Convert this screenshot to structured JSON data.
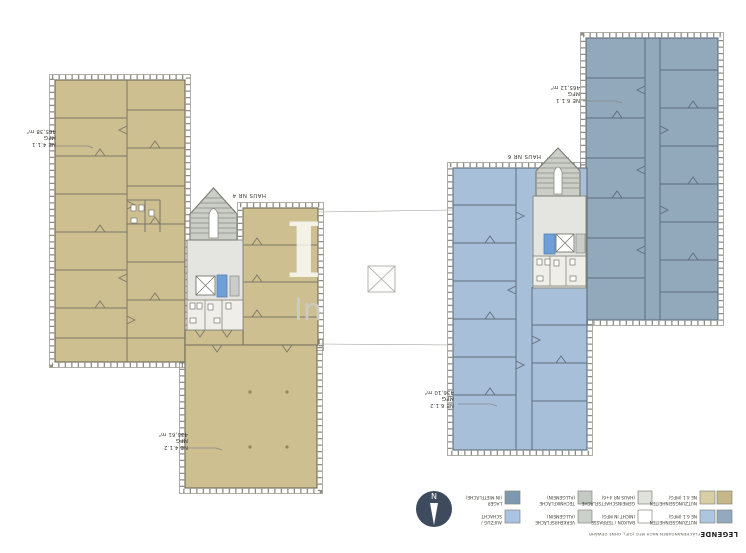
{
  "plan": {
    "areas": [
      {
        "unit": "NE 4.1.1",
        "use": "MFG",
        "area": "465,38 m²"
      },
      {
        "unit": "NE 4.1.2",
        "use": "MFG",
        "area": "435,61 m²"
      },
      {
        "unit": "NE 6.1.1",
        "use": "MFG",
        "area": "465,12 m²"
      },
      {
        "unit": "NE 6.1.2",
        "use": "MFG",
        "area": "436,10 m²"
      }
    ],
    "houses": [
      {
        "label": "HAUS NR 4"
      },
      {
        "label": "HAUS NR 6"
      }
    ]
  },
  "legend": {
    "title": "LEGENDE",
    "note": "FLÄCHENANGABEN NACH MFG (GIF), OHNE GEWÄHR",
    "items": [
      {
        "label": [
          "LAGER",
          "(IN MIETFLÄCHE)"
        ],
        "color": "#7d99b0"
      },
      {
        "label": [
          "AUFZUG /",
          "SCHACHT"
        ],
        "color": "#a9c4e2"
      },
      {
        "label": [
          "TECHNIKFLÄCHE",
          "(ALLGEMEIN)"
        ],
        "color": "#c6cac5"
      },
      {
        "label": [
          "VERKEHRSFLÄCHE",
          "(ALLGEMEIN)"
        ],
        "color": "#cdd1cc"
      },
      {
        "label": [
          "GEMEINSCHAFTSFLÄCHE",
          "(HAUS NR 4+6)"
        ],
        "color": "#dfe1dd"
      },
      {
        "label": [
          "BALKON / TERRASSE",
          "(NICHT IN MFG)"
        ],
        "color": "#ffffff"
      },
      {
        "label": [
          "NUTZUNGSEINHEITEN",
          "NE 4.1 (MFG)"
        ],
        "colors": [
          "#d9cda4",
          "#c5b787"
        ]
      },
      {
        "label": [
          "NUTZUNGSEINHEITEN",
          "NE 6.1 (MFG)"
        ],
        "colors": [
          "#adc6e0",
          "#93aabe"
        ]
      }
    ]
  },
  "compass": {
    "label": "N"
  },
  "watermark": {
    "initial": "I",
    "text": "In"
  },
  "colors": {
    "haus4_fill": "#cdbf90",
    "haus6_light": "#a8bfd9",
    "haus6_dark": "#92a8bb",
    "core_gray": "#e4e4e0",
    "stair_gray": "#cbcdc7",
    "elevator_blue": "#6f9fd8",
    "compass_bg": "#3e4b5c"
  }
}
